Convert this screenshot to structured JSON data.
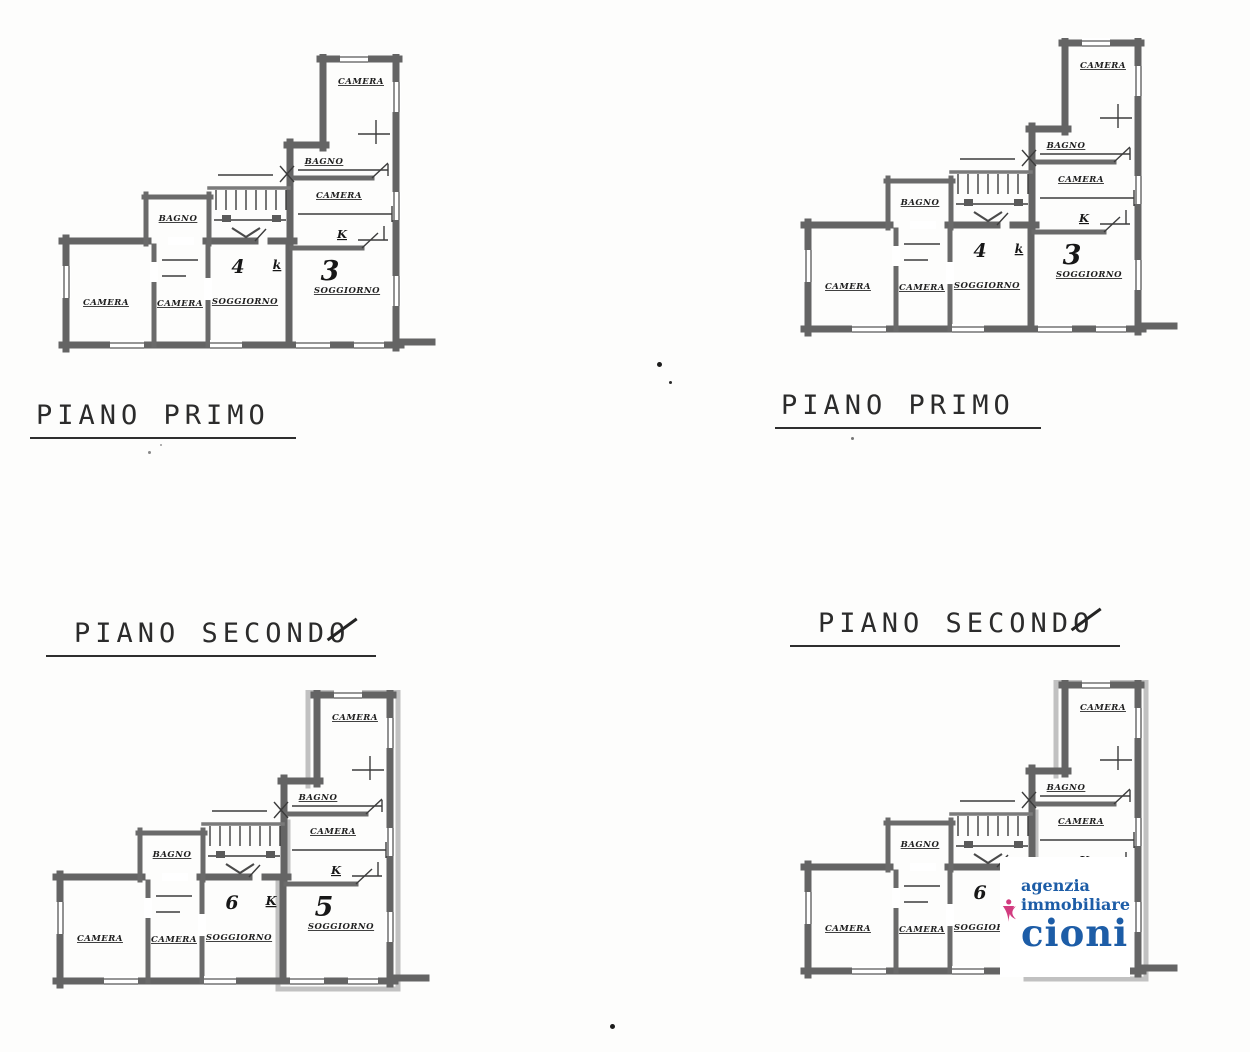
{
  "titles": {
    "primo_left": "PIANO PRIMO",
    "primo_right": "PIANO PRIMO",
    "secondo_left": "PIANO SECONDO",
    "secondo_right": "PIANO SECONDO"
  },
  "plans": [
    {
      "name": "piano-primo-left",
      "highlight": false,
      "rooms": {
        "camera_top": "CAMERA",
        "bagno_right": "BAGNO",
        "camera_right": "CAMERA",
        "kitchen_right": "K",
        "unit_right": "3",
        "soggiorno_right": "SOGGIORNO",
        "bagno_left": "BAGNO",
        "unit_mid": "4",
        "kitchen_mid": "k",
        "camera_bl": "CAMERA",
        "camera_bm": "CAMERA",
        "soggiorno_mid": "SOGGIORNO"
      }
    },
    {
      "name": "piano-primo-right",
      "highlight": false,
      "rooms": {
        "camera_top": "CAMERA",
        "bagno_right": "BAGNO",
        "camera_right": "CAMERA",
        "kitchen_right": "K",
        "unit_right": "3",
        "soggiorno_right": "SOGGIORNO",
        "bagno_left": "BAGNO",
        "unit_mid": "4",
        "kitchen_mid": "k",
        "camera_bl": "CAMERA",
        "camera_bm": "CAMERA",
        "soggiorno_mid": "SOGGIORNO"
      }
    },
    {
      "name": "piano-secondo-left",
      "highlight": true,
      "rooms": {
        "camera_top": "CAMERA",
        "bagno_right": "BAGNO",
        "camera_right": "CAMERA",
        "kitchen_right": "K",
        "unit_right": "5",
        "soggiorno_right": "SOGGIORNO",
        "bagno_left": "BAGNO",
        "unit_mid": "6",
        "kitchen_mid": "K",
        "camera_bl": "CAMERA",
        "camera_bm": "CAMERA",
        "soggiorno_mid": "SOGGIORNO"
      }
    },
    {
      "name": "piano-secondo-right",
      "highlight": true,
      "rooms": {
        "camera_top": "CAMERA",
        "bagno_right": "BAGNO",
        "camera_right": "CAMERA",
        "kitchen_right": "K",
        "unit_right": "5",
        "soggiorno_right": "SOGGIORNO",
        "bagno_left": "BAGNO",
        "unit_mid": "6",
        "kitchen_mid": "K",
        "camera_bl": "CAMERA",
        "camera_bm": "CAMERA",
        "soggiorno_mid": "SOGGIORNO"
      }
    }
  ],
  "logo": {
    "line1": "agenzia",
    "line2": "immobiliare",
    "name": "cioni",
    "pink": "#d23c80",
    "blue": "#1d5da7"
  }
}
